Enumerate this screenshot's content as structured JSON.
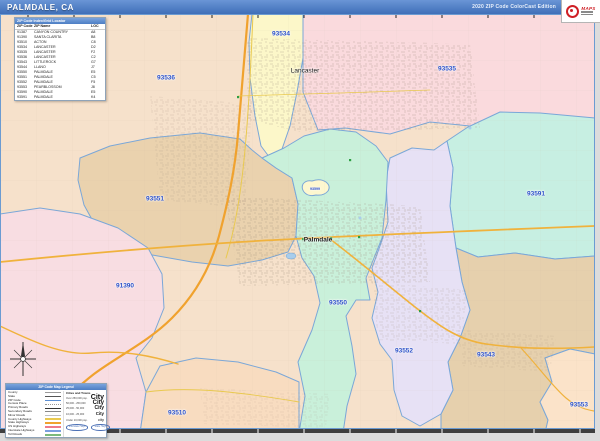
{
  "header": {
    "title": "PALMDALE, CA",
    "edition": "2020 ZIP Code ColorCast Edition",
    "logo_brand": "MAPS"
  },
  "zip_table": {
    "title": "ZIP Code Index/Grid Locator",
    "columns": [
      "ZIP Code",
      "ZIP Name",
      "LOC"
    ],
    "rows": [
      {
        "zip": "91387",
        "name": "CANYON COUNTRY",
        "loc": "A8"
      },
      {
        "zip": "91390",
        "name": "SANTA CLARITA",
        "loc": "B8"
      },
      {
        "zip": "93510",
        "name": "ACTON",
        "loc": "C8"
      },
      {
        "zip": "93534",
        "name": "LANCASTER",
        "loc": "D2"
      },
      {
        "zip": "93535",
        "name": "LANCASTER",
        "loc": "F2"
      },
      {
        "zip": "93536",
        "name": "LANCASTER",
        "loc": "C2"
      },
      {
        "zip": "93543",
        "name": "LITTLEROCK",
        "loc": "G7"
      },
      {
        "zip": "93544",
        "name": "LLANO",
        "loc": "J7"
      },
      {
        "zip": "93550",
        "name": "PALMDALE",
        "loc": "E5"
      },
      {
        "zip": "93551",
        "name": "PALMDALE",
        "loc": "C5"
      },
      {
        "zip": "93552",
        "name": "PALMDALE",
        "loc": "F5"
      },
      {
        "zip": "93553",
        "name": "PEARBLOSSOM",
        "loc": "J8"
      },
      {
        "zip": "93590",
        "name": "PALMDALE",
        "loc": "E5"
      },
      {
        "zip": "93591",
        "name": "PALMDALE",
        "loc": "K4"
      }
    ]
  },
  "map": {
    "city_labels": [
      {
        "text": "Lancaster"
      },
      {
        "text": "Palmdale"
      }
    ],
    "zip_labels": [
      {
        "text": "93534"
      },
      {
        "text": "93536"
      },
      {
        "text": "93535"
      },
      {
        "text": "93551"
      },
      {
        "text": "93599"
      },
      {
        "text": "93591"
      },
      {
        "text": "91390"
      },
      {
        "text": "93550"
      },
      {
        "text": "93552"
      },
      {
        "text": "93543"
      },
      {
        "text": "93510"
      },
      {
        "text": "93553"
      }
    ],
    "region_colors": {
      "z91390": "#f8dde2",
      "z93510": "#f8dcc0",
      "z93534": "#fcf7c9",
      "z93535": "#fadadd",
      "z93536": "#f6e1cb",
      "z93543": "#e6d0ad",
      "z93550": "#c9f0da",
      "z93551": "#ead2ae",
      "z93552": "#e7e1f5",
      "z93553": "#fbe3c9",
      "z93591": "#c7efe2",
      "z93599": "#fdf7cf"
    },
    "zip_label_color": "#2b50c8",
    "boundary_color": "#7aa7d8",
    "highway_color": "#f0a22e"
  },
  "legend": {
    "title": "ZIP Code Map Legend",
    "items": [
      "County",
      "State",
      "ZIP Code",
      "Census Place",
      "Primary Roads",
      "Secondary Roads",
      "Minor Roads",
      "County Highways",
      "State Highways",
      "US Highways",
      "Interstate Highways",
      "Toll Roads"
    ],
    "cities_title": "Cities and Towns",
    "city_classes": [
      {
        "range": "Over 250,000 pop.",
        "sample": "City"
      },
      {
        "range": "50,000 - 250,000",
        "sample": "City"
      },
      {
        "range": "25,000 - 50,000",
        "sample": "City"
      },
      {
        "range": "10,000 - 25,000",
        "sample": "City"
      },
      {
        "range": "Under 10,000 pop.",
        "sample": "city"
      }
    ],
    "shields": [
      {
        "label": "Interstate Hwys"
      },
      {
        "label": "State Hwys"
      }
    ]
  }
}
